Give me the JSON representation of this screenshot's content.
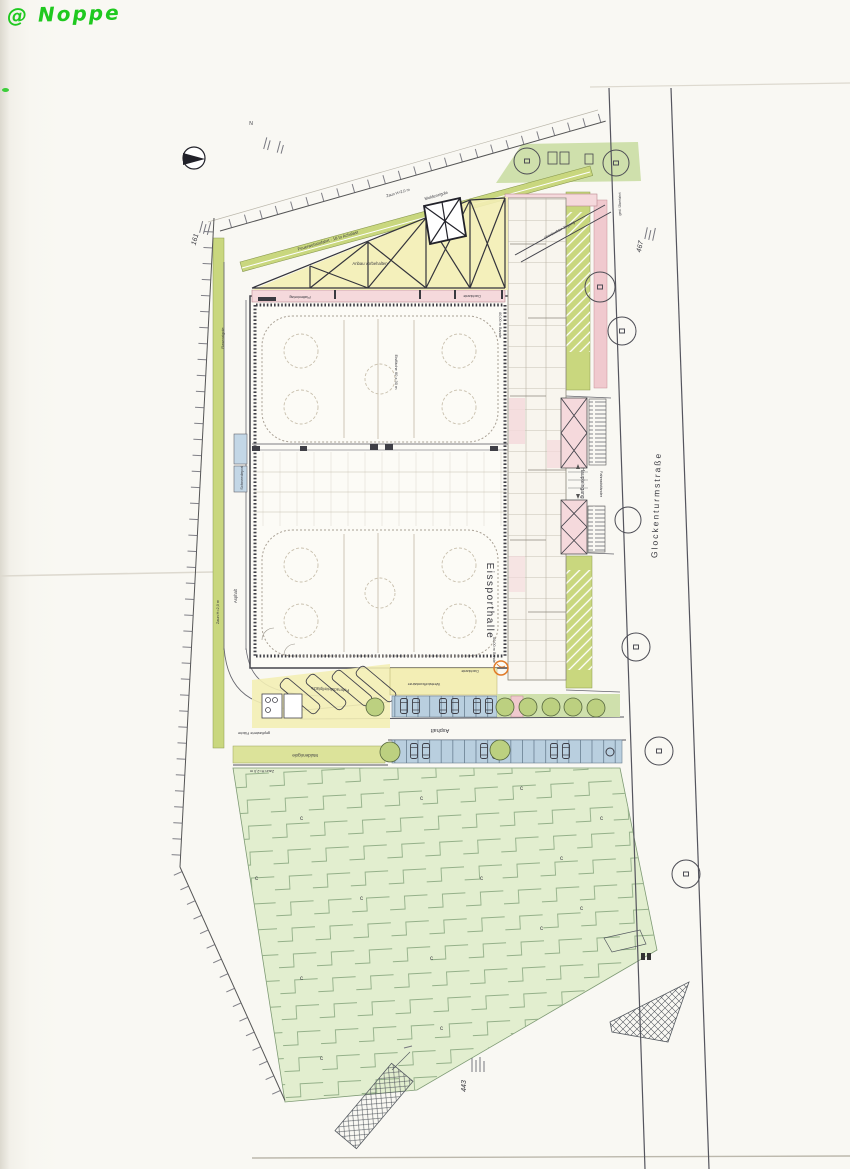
{
  "watermark": {
    "text": "@ Noppe",
    "color": "#1fc91f"
  },
  "page": {
    "parcel_left": "161",
    "parcel_right": "467",
    "parcel_bottom": "443",
    "north": "N"
  },
  "street": {
    "name": "Glockenturmstraße"
  },
  "building": {
    "name": "Eissporthalle",
    "rink_note": "Eisfläche 60 x 30 m",
    "band_note": "60,00 m Bande",
    "annex_note": "Anbau vorbehalten"
  },
  "site": {
    "fence_20": "Zaun H=2,0 m",
    "fence_25": "Zaun H=2,5 m",
    "fire_lane": "Feuerwehrzufahrt · 18 to Achslast",
    "swale": "Muldenrigole",
    "lawn_swale": "Rasenrigole",
    "asphalt": "Asphalt",
    "paving": "Plattenbelag",
    "roof_edge": "Dachkante",
    "paved_area": "gepflasterte Fläche",
    "snow_depot": "Schneedepot",
    "main_entrance": "Haupteingang",
    "bike_racks": "Fahrradständer",
    "bike_parking": "Fahrradabstellplätze",
    "covered_walk": "überdachter Zugang",
    "crossing": "ged. Überfahrt",
    "container": "Wertstoffcontainer",
    "slope_mark": "c"
  },
  "colors": {
    "lawn": "#cfe0ac",
    "slope": "#e2eecf",
    "swale_strip": "#c9d77e",
    "paving_yellow": "#f3eeb5",
    "canopy_pink": "#f5d9dc",
    "parking_blue": "#b9cfdf",
    "accent_orange": "#e07a28",
    "ink": "#3c3c44",
    "watermark_green": "#1fc91f"
  }
}
